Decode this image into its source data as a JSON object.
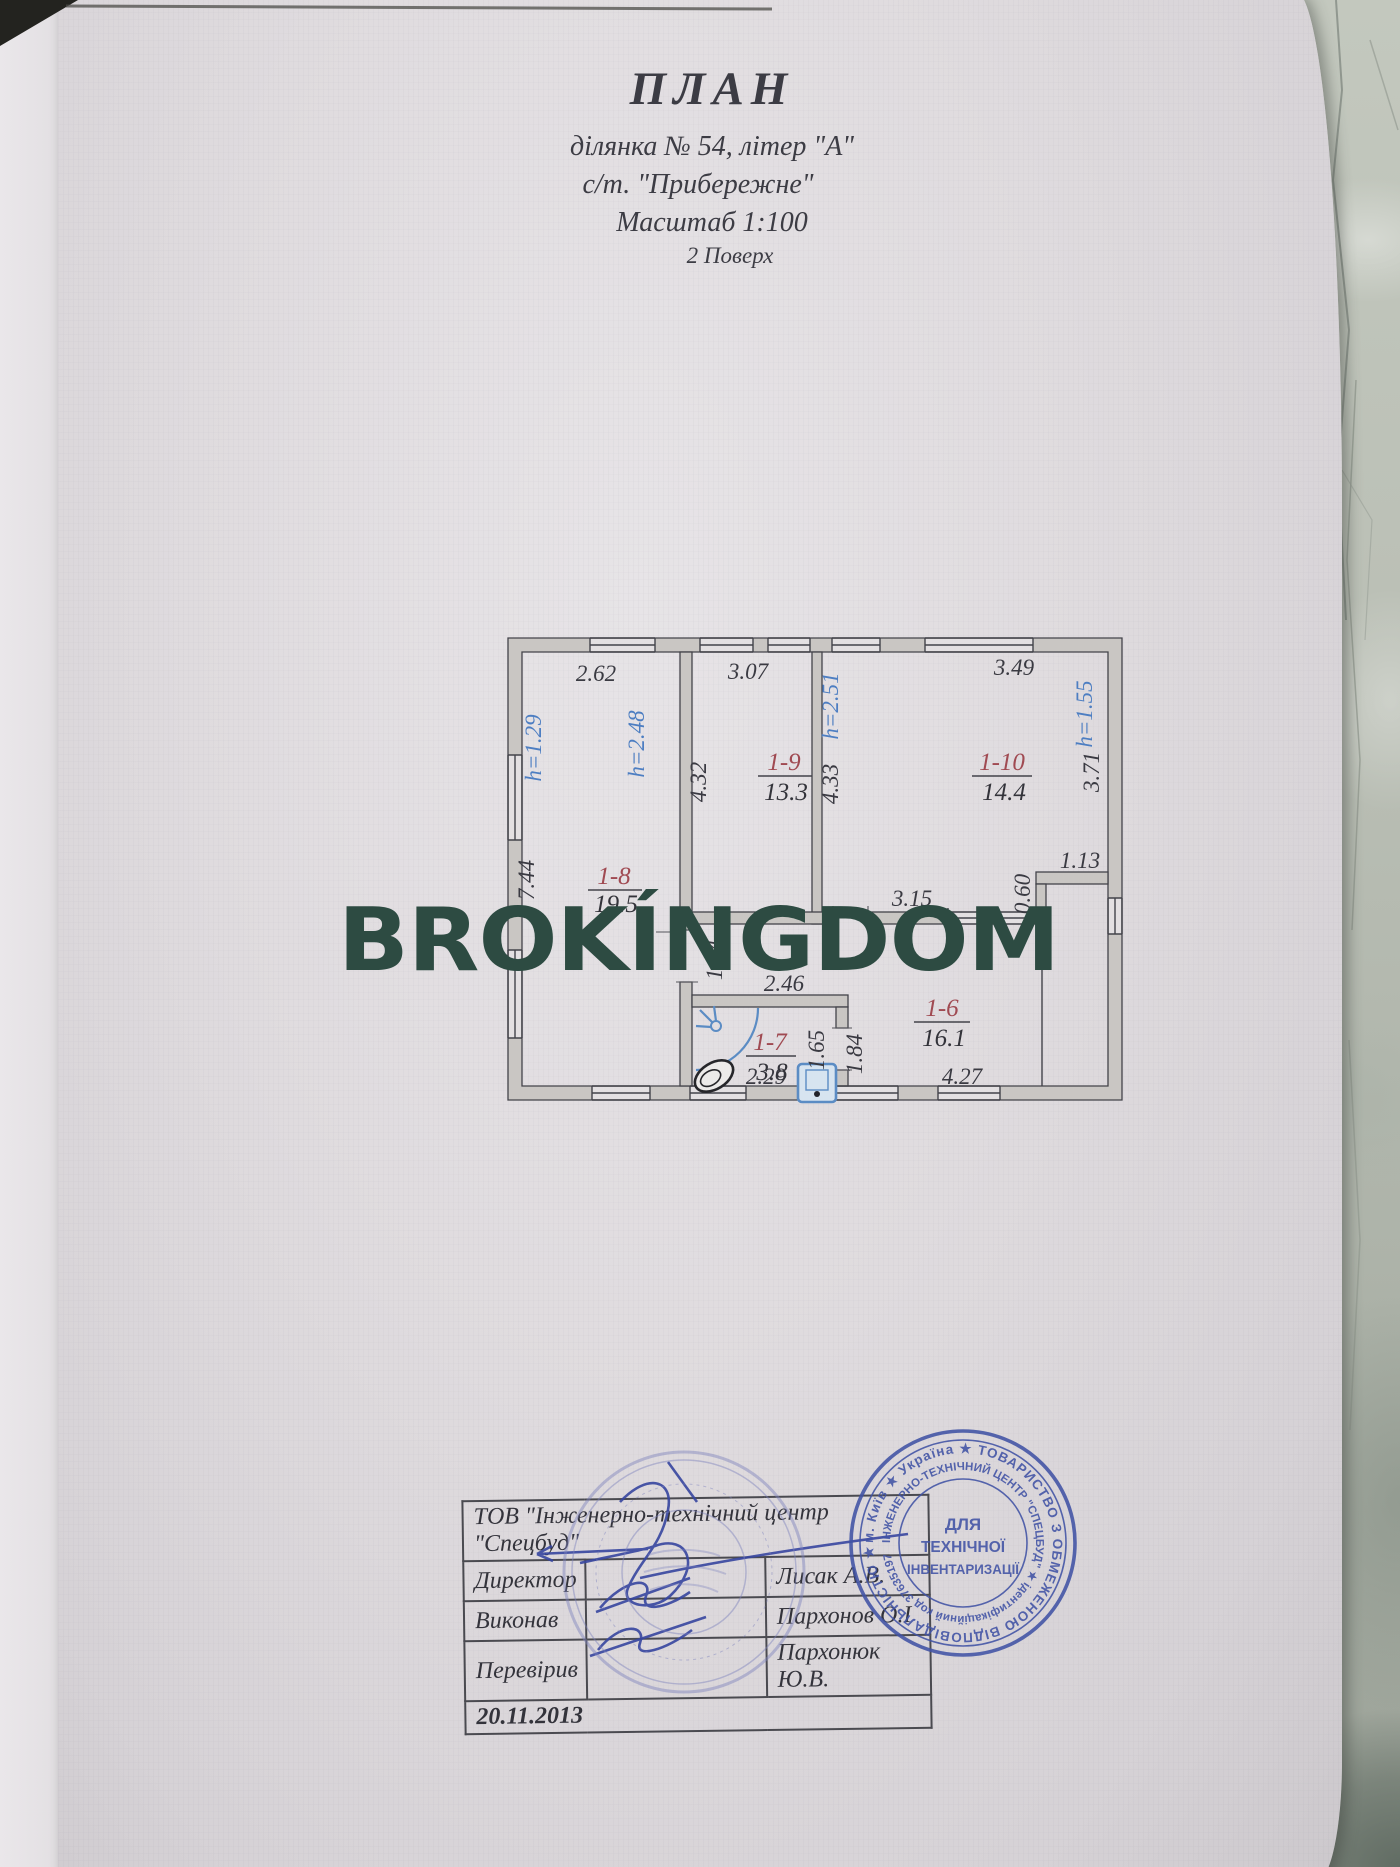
{
  "watermark": "BROKÍNGDOM",
  "title": {
    "heading": "ПЛАН",
    "line1": "ділянка № 54, літер \"А\"",
    "line2": "с/т. \"Прибережне\"",
    "line3": "Масштаб 1:100",
    "line4": "2 Поверх"
  },
  "plan": {
    "rooms": [
      {
        "code": "1-8",
        "area": "19.5"
      },
      {
        "code": "1-9",
        "area": "13.3"
      },
      {
        "code": "1-10",
        "area": "14.4"
      },
      {
        "code": "1-7",
        "area": "3.8"
      },
      {
        "code": "1-6",
        "area": "16.1"
      }
    ],
    "dims": {
      "top1": "2.62",
      "top2": "3.07",
      "top3": "3.49",
      "niche_w": "1.13",
      "niche_d": "0.60",
      "bath_top": "2.46",
      "bath_bottom": "2.29",
      "r6_bottom": "4.27",
      "left": "7.44",
      "v1": "4.32",
      "v2": "4.33",
      "v3": "3.71",
      "stub": "1.14",
      "door_in": "1.65",
      "door_out": "1.84",
      "hidden_mid": "3.15"
    },
    "heights": {
      "h1": "h=1.29",
      "h2": "h=2.48",
      "h3": "h=2.51",
      "h4": "h=1.55"
    }
  },
  "table": {
    "header": "ТОВ \"Інженерно-технічний центр \"Спецбуд\"",
    "rows": [
      {
        "label": "Директор",
        "name": "Лисак А.В."
      },
      {
        "label": "Виконав",
        "name": "Пархонов О.І"
      },
      {
        "label": "Перевірив",
        "name": "Пархонюк Ю.В."
      }
    ],
    "date": "20.11.2013"
  },
  "stamp": {
    "center1": "ДЛЯ",
    "center2": "ТЕХНІЧНОЇ",
    "center3": "ІНВЕНТАРИЗАЦІЇ",
    "ring_outer": "м. Київ ★ Україна ★ ТОВАРИСТВО З ОБМЕЖЕНОЮ ВІДПОВІДАЛЬНІСТЮ ★",
    "ring_inner": "ІНЖЕНЕРНО-ТЕХНІЧНИЙ ЦЕНТР \"СПЕЦБУД\" ★ ідентифікаційний код 37635197"
  }
}
